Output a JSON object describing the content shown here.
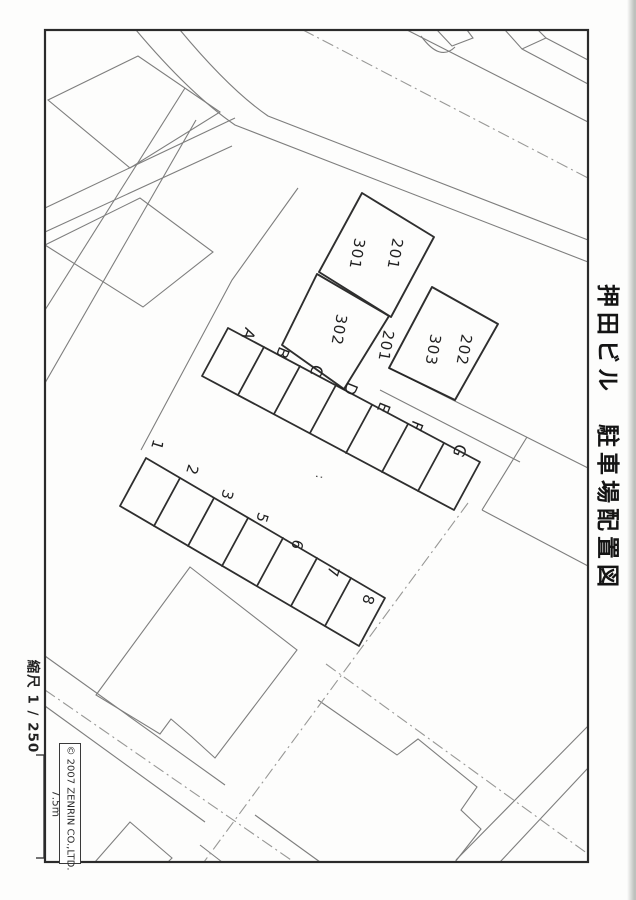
{
  "header": {
    "title": "押田ビル　駐車場配置図"
  },
  "legend": {
    "scale_label": "縮尺 1 / 250",
    "scale_bar_length": "7.5m",
    "copyright": "© 2007 ZENRIN CO.,LTD."
  },
  "map": {
    "building_unit_labels": {
      "upper_201": "201",
      "upper_301": "301",
      "mid_302": "302",
      "mid_201": "201",
      "right_202": "202",
      "right_303": "303"
    },
    "parking_row_letters": [
      "A",
      "B",
      "C",
      "D",
      "E",
      "F",
      "G"
    ],
    "parking_row_numbers": [
      "1",
      "2",
      "3",
      "5",
      "6",
      "7",
      "8"
    ],
    "dots_mark": ":",
    "colors": {
      "frame": "#2b2b2b",
      "survey_line": "#686868",
      "centerline": "#989896",
      "hand_ink": "#1d1d1d"
    }
  }
}
